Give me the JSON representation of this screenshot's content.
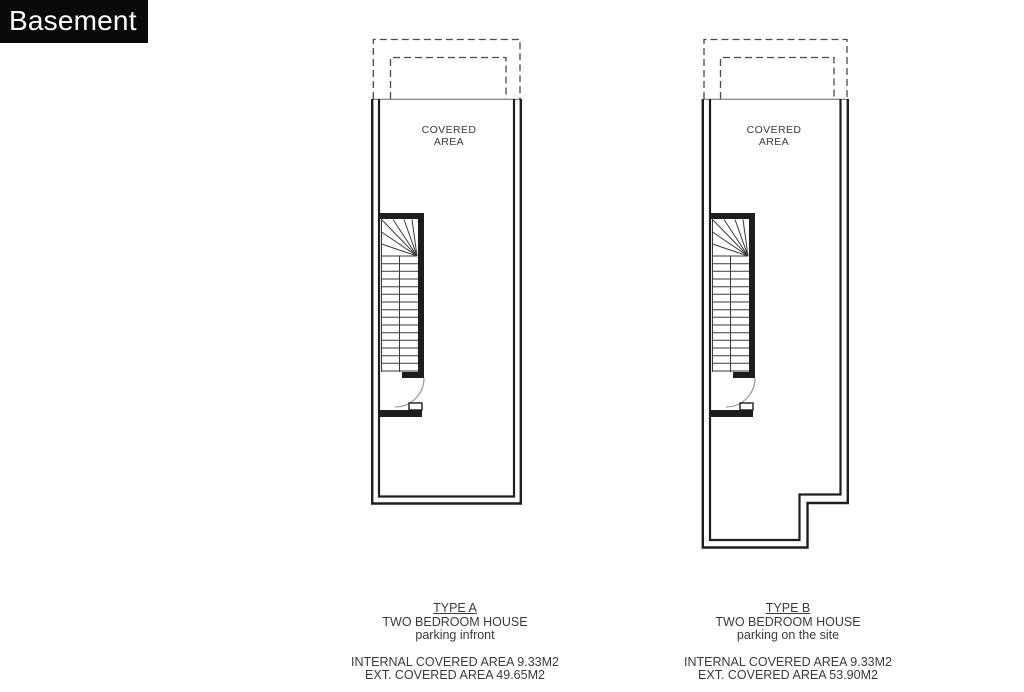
{
  "header": {
    "title": "Basement"
  },
  "plans": [
    {
      "covered_area": "COVERED\nAREA",
      "type_label": "TYPE A",
      "house_type": "TWO BEDROOM HOUSE",
      "parking": "parking infront",
      "internal_area": "INTERNAL COVERED AREA 9.33M2",
      "external_area": "EXT. COVERED AREA 49.65M2"
    },
    {
      "covered_area": "COVERED\nAREA",
      "type_label": "TYPE B",
      "house_type": "TWO BEDROOM HOUSE",
      "parking": "parking on the site",
      "internal_area": "INTERNAL COVERED AREA 9.33M2",
      "external_area": "EXT. COVERED AREA 53.90M2"
    }
  ],
  "colors": {
    "background": "#ffffff",
    "badge_background": "#0a0a0a",
    "badge_text": "#ffffff",
    "wall_line": "#1f1f1f",
    "thin_line": "#3a3a3a",
    "dashed_line": "#4a4a4a",
    "door_arc": "#999999",
    "text": "#3a3a3a"
  }
}
